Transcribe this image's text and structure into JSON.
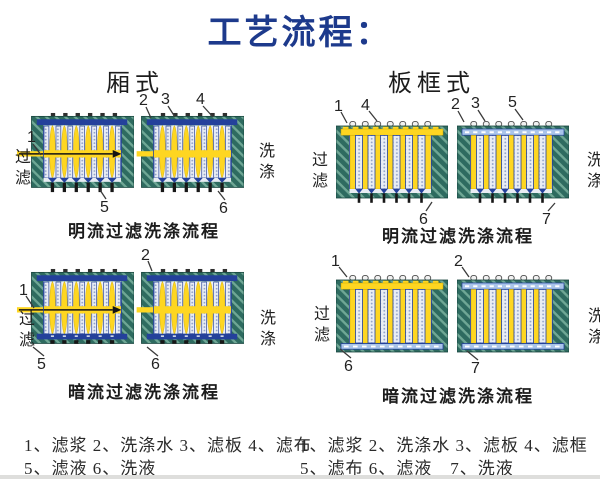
{
  "title": "工艺流程：",
  "column_headers": {
    "left": "厢式",
    "right": "板框式"
  },
  "groups": [
    {
      "caption": "明流过滤洗涤流程",
      "side_left": "过滤",
      "side_right": "洗涤",
      "callouts": [
        "1",
        "2",
        "3",
        "4",
        "5",
        "6"
      ]
    },
    {
      "caption": "明流过滤洗涤流程",
      "side_left": "过滤",
      "side_right": "洗涤",
      "callouts": [
        "1",
        "4",
        "2",
        "3",
        "5",
        "6",
        "7"
      ]
    },
    {
      "caption": "暗流过滤洗涤流程",
      "side_left": "过滤",
      "side_right": "洗涤",
      "callouts": [
        "1",
        "2",
        "5",
        "6"
      ]
    },
    {
      "caption": "暗流过滤洗涤流程",
      "side_left": "过滤",
      "side_right": "洗涤",
      "callouts": [
        "1",
        "2",
        "6",
        "7"
      ]
    }
  ],
  "legend": {
    "left_lines": [
      "1、滤浆 2、洗涤水 3、滤板 4、滤布",
      "5、滤液 6、洗液"
    ],
    "right_lines": [
      "1、滤浆 2、洗涤水 3、滤板 4、滤框",
      "5、滤布 6、滤液　7、洗液"
    ]
  },
  "colors": {
    "title_blue": "#1d3a8c",
    "teal": "#2e6b60",
    "teal_light": "#6fa795",
    "blue": "#24419b",
    "yellow": "#fed621",
    "dot_bg": "#e9edf4",
    "dot": "#90a2c8",
    "light_blue_band": "#a9c4ea",
    "ink": "#1f1f1f"
  }
}
